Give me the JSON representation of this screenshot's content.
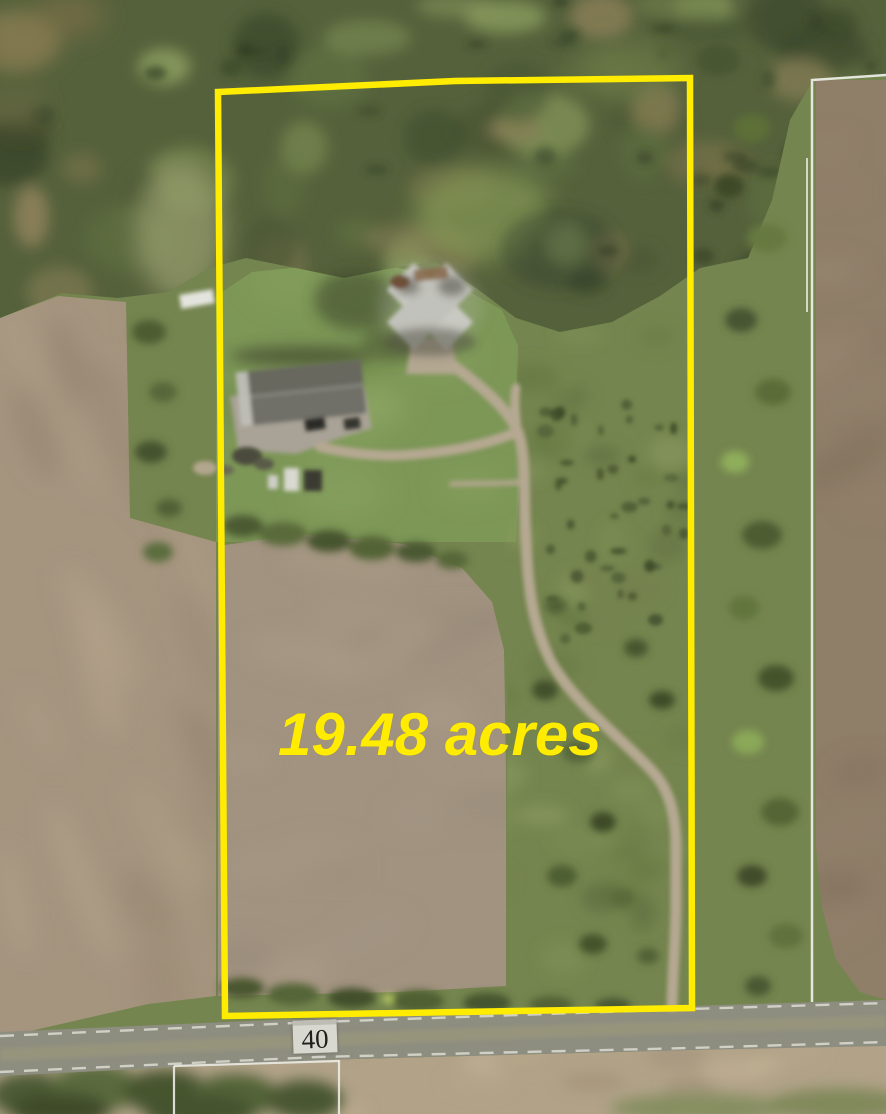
{
  "map": {
    "type": "aerial-parcel-map",
    "area_label": "19.48 acres",
    "area_acres": 19.48,
    "road_sign": {
      "number": "40"
    },
    "parcel": {
      "boundary_points": "218,92 455,81 690,78 692,1008 225,1016"
    }
  },
  "colors": {
    "boundary-yellow": "#ffec00",
    "label-yellow": "#ffec00",
    "survey-white": "#ebebe4",
    "road-gray": "#8d8d80",
    "road-stripe": "#9a967c",
    "sign-bg": "#d8d8d0",
    "sign-text": "#1e1e1a",
    "scrub-green": "#75854f",
    "forest-green": "#55613b",
    "lawn-green": "#7d9757",
    "field-tan": "#a5957f",
    "inner-field-tan": "#a29381",
    "right-field-brown": "#8f7e68",
    "bottom-tan": "#b1a288",
    "driveway-tan": "#b5a892",
    "roof-dark": "#6f6f67",
    "roof-light": "#c6c6c0"
  }
}
